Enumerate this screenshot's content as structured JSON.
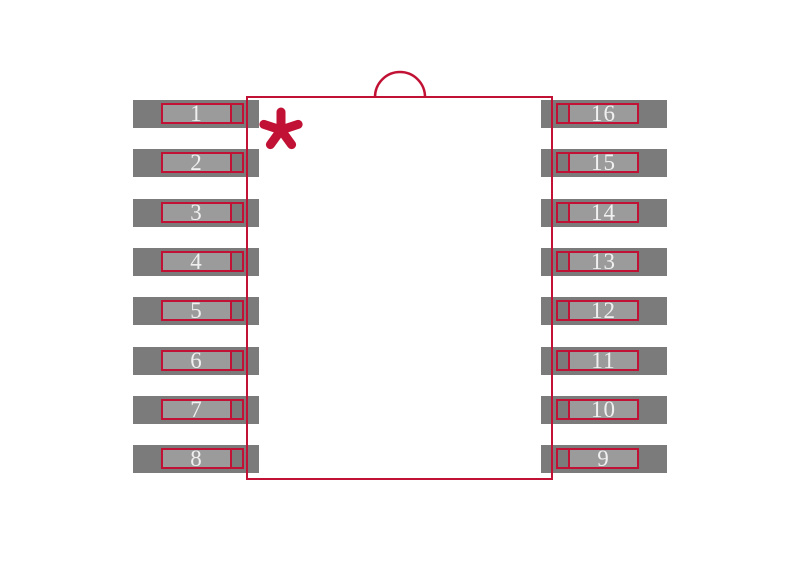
{
  "footprint": {
    "title": "16-pin SOIC package footprint",
    "left_pins": [
      "1",
      "2",
      "3",
      "4",
      "5",
      "6",
      "7",
      "8"
    ],
    "right_pins": [
      "16",
      "15",
      "14",
      "13",
      "12",
      "11",
      "10",
      "9"
    ],
    "pin_one_marker": "asterisk",
    "orientation_feature": "top-center半circle notch",
    "colors": {
      "pad": "#7b7b7b",
      "lead": "#9b9b9b",
      "outline": "#c11235",
      "label": "#f0f0f0",
      "background": "#ffffff"
    }
  }
}
